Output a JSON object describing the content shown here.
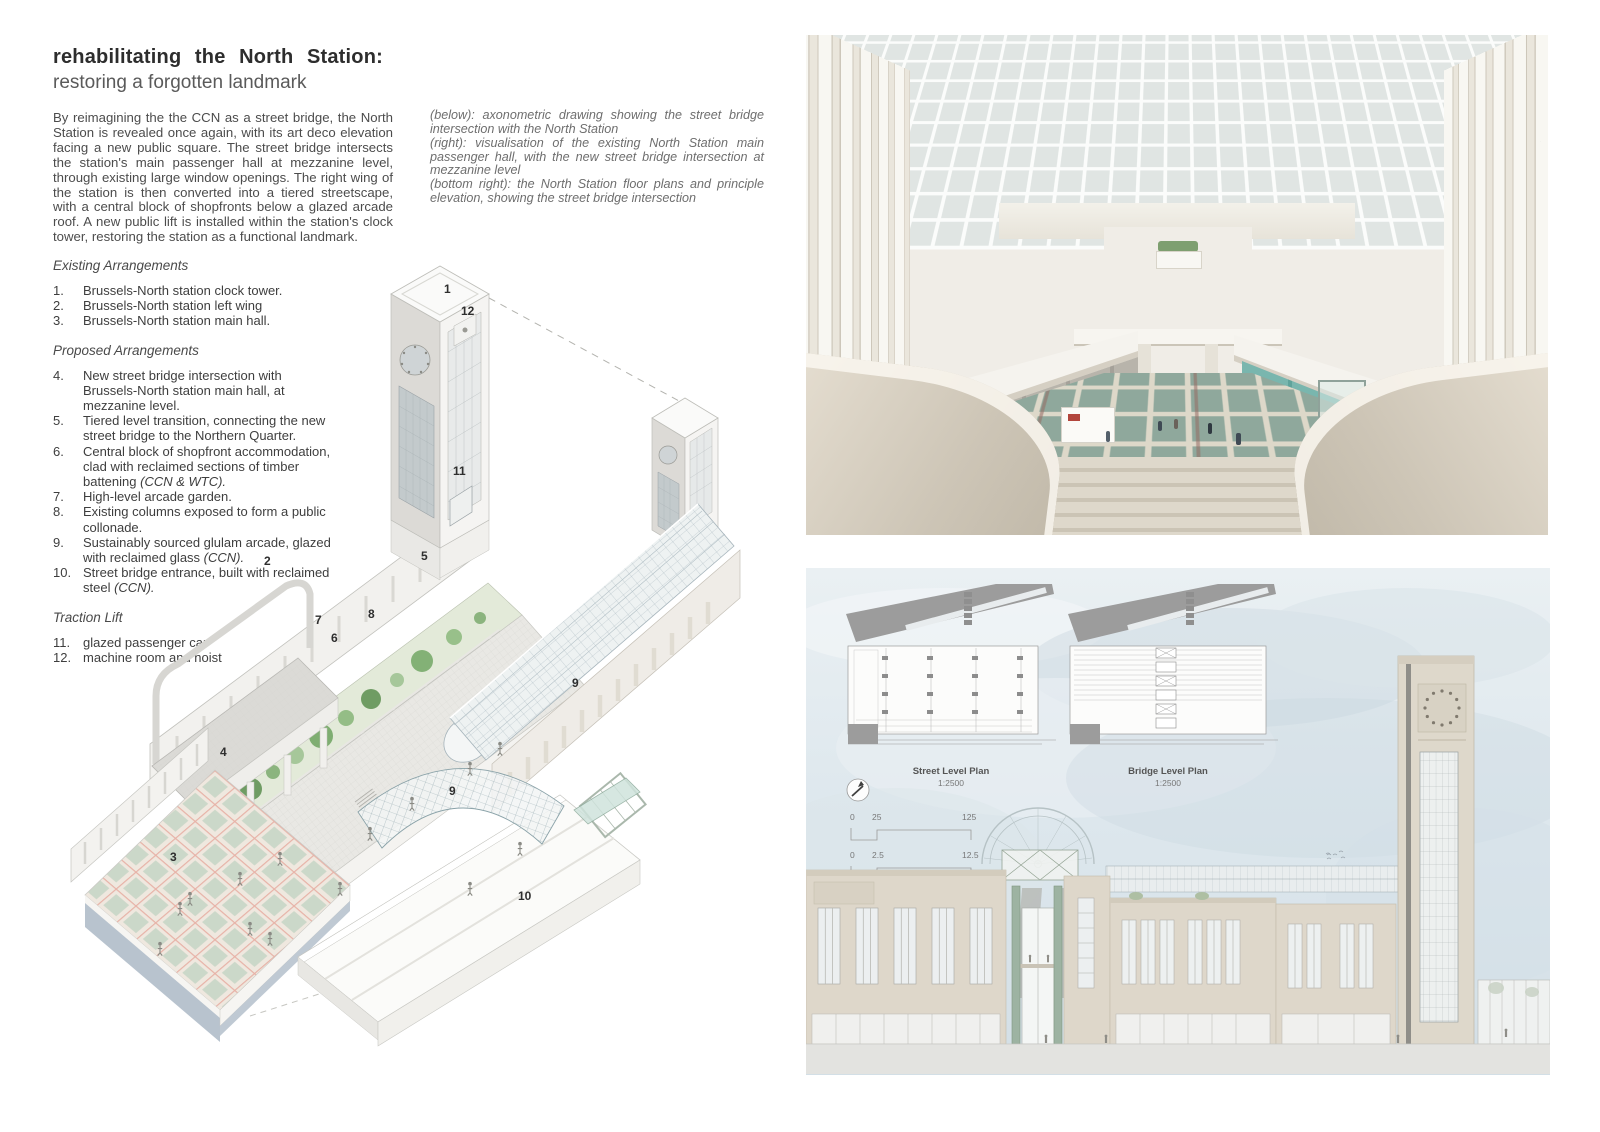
{
  "board": {
    "title_line1": "rehabilitating the North Station:",
    "title_line2": "restoring a forgotten landmark",
    "intro": "By reimagining the the CCN as a street bridge, the North Station is revealed once again, with its art deco elevation facing a new public square. The street bridge intersects the station's main passenger hall at mezzanine level, through existing large window openings. The right wing of the station is then converted into a tiered streetscape, with a central block of shopfronts below a glazed arcade roof. A new public lift is installed within the station's clock tower, restoring the station as a functional landmark.",
    "captions": [
      "(below): axonometric drawing showing the street bridge intersection with the North Station",
      "(right): visualisation of the existing North Station main passenger hall, with the new street bridge intersection at mezzanine level",
      "(bottom right): the North Station floor plans and principle elevation, showing the street bridge intersection"
    ]
  },
  "legend": {
    "existing": {
      "heading": "Existing Arrangements",
      "items": [
        {
          "num": "1.",
          "text": "Brussels-North station clock tower.",
          "italic": ""
        },
        {
          "num": "2.",
          "text": "Brussels-North station left wing",
          "italic": ""
        },
        {
          "num": "3.",
          "text": "Brussels-North station main hall.",
          "italic": ""
        }
      ]
    },
    "proposed": {
      "heading": "Proposed Arrangements",
      "items": [
        {
          "num": "4.",
          "text": "New street bridge intersection with Brussels-North station main hall, at mezzanine level.",
          "italic": ""
        },
        {
          "num": "5.",
          "text": "Tiered level transition, connecting the new street bridge to the Northern Quarter.",
          "italic": ""
        },
        {
          "num": "6.",
          "text": "Central block of shopfront accommodation, clad with reclaimed sections of timber battening ",
          "italic": "(CCN & WTC)."
        },
        {
          "num": "7.",
          "text": "High-level arcade garden.",
          "italic": ""
        },
        {
          "num": "8.",
          "text": "Existing columns exposed to form a public collonade.",
          "italic": ""
        },
        {
          "num": "9.",
          "text": "Sustainably sourced glulam arcade, glazed with reclaimed glass ",
          "italic": "(CCN)."
        },
        {
          "num": "10.",
          "text": "Street bridge entrance, built with reclaimed steel ",
          "italic": "(CCN)."
        }
      ]
    },
    "traction": {
      "heading": "Traction Lift",
      "items": [
        {
          "num": "11.",
          "text": "glazed passenger car",
          "italic": ""
        },
        {
          "num": "12.",
          "text": "machine room and hoist",
          "italic": ""
        }
      ]
    }
  },
  "axon": {
    "labels": [
      {
        "n": "1"
      },
      {
        "n": "12"
      },
      {
        "n": "11"
      },
      {
        "n": "2"
      },
      {
        "n": "5"
      },
      {
        "n": "8"
      },
      {
        "n": "7"
      },
      {
        "n": "6"
      },
      {
        "n": "4"
      },
      {
        "n": "3"
      },
      {
        "n": "9"
      },
      {
        "n": "9"
      },
      {
        "n": "10"
      }
    ]
  },
  "plans": {
    "street": {
      "label": "Street Level Plan",
      "scale": "1:2500"
    },
    "bridge": {
      "label": "Bridge Level Plan",
      "scale": "1:2500"
    },
    "scalebar1": {
      "start": "0",
      "mid": "25",
      "end": "125"
    },
    "scalebar2": {
      "start": "0",
      "mid": "2.5",
      "end": "12.5"
    }
  },
  "colors": {
    "teal_storefront": "#6fb0a8",
    "floor_tile_green": "#8fa89c",
    "floor_grid_pink": "#e7b2a7",
    "axon_tree_green": "#8bb47e",
    "sky_blue": "#dde7ed",
    "stone_beige": "#ded7ca"
  }
}
